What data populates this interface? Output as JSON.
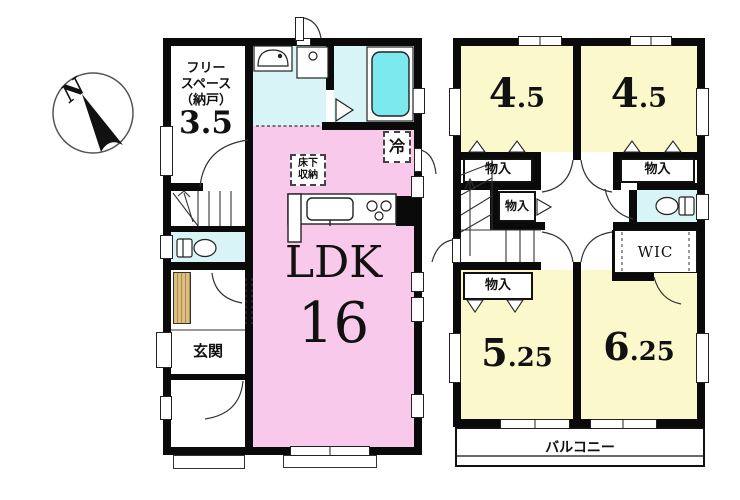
{
  "compass": {
    "north_label": "N"
  },
  "floor1": {
    "free_space": {
      "line1": "フリー",
      "line2": "スペース",
      "line3": "（納戸）",
      "size": "3.5"
    },
    "ldk": {
      "label": "LDK",
      "size": "16"
    },
    "underfloor_storage": {
      "line1": "床下",
      "line2": "収納"
    },
    "refrigerator": "冷",
    "entrance": "玄関"
  },
  "floor2": {
    "room_top_left": {
      "main": "4",
      "dec": ".5"
    },
    "room_top_right": {
      "main": "4",
      "dec": ".5"
    },
    "room_bottom_left": {
      "main": "5",
      "dec": ".25"
    },
    "room_bottom_right": {
      "main": "6",
      "dec": ".25"
    },
    "closet_top_left": "物入",
    "closet_top_right": "物入",
    "closet_middle": "物入",
    "closet_bottom_left": "物入",
    "wic": "WIC",
    "balcony": "バルコニー"
  },
  "colors": {
    "ldk_pink": "#F8C9EA",
    "room_yellow": "#FBF8CC",
    "wet_area_cyan": "#D9F4F6",
    "bathtub_cyan": "#7CE9EE",
    "shoe_cabinet_tan": "#DCBF80",
    "wall_black": "#0A0A0A"
  }
}
